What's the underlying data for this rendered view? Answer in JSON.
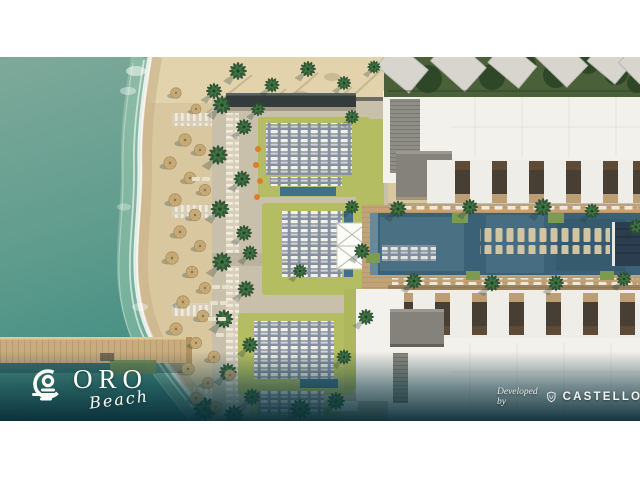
{
  "branding": {
    "logo": {
      "name": "ORO",
      "tagline": "Beach"
    },
    "developer": {
      "prefix": "Developed by",
      "name": "CASTELLO"
    }
  },
  "palette": {
    "sea_top": "#7ea99a",
    "sea_mid": "#5f9c8d",
    "sea_deep": "#3e8b80",
    "foam": "#ffffff",
    "sand": "#d9c7a0",
    "sand_light": "#e4d6b0",
    "lawn": "#b5bd62",
    "pool": "#3b6176",
    "pool_small": "#41708a",
    "building": "#f3f1ec",
    "roof_grey": "#84827a",
    "pergola": "#333b3b",
    "wood_deck": "#c2a377",
    "pier_wood": "#c9ac7e",
    "villa_green": "#4a6038",
    "navy_cabana": "#2c3d50",
    "accent_orange": "#e07b28",
    "scrim": "#0e3742"
  },
  "scene": {
    "landmarks": [
      "lagoon sea",
      "surf line",
      "sand beach",
      "straw umbrellas",
      "palm trees",
      "timber pier",
      "beach club sun decks",
      "lawn gardens",
      "event tent",
      "plunge pools",
      "resort lap pool",
      "in-pool loungers",
      "north residence block",
      "south residence block",
      "garden villas"
    ]
  }
}
